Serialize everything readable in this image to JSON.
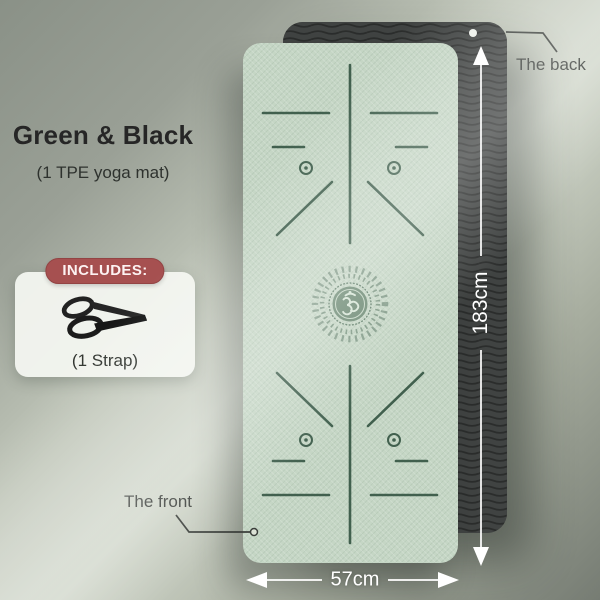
{
  "header": {
    "title": "Green & Black",
    "subtitle": "(1 TPE yoga mat)"
  },
  "includes": {
    "badge_label": "INCLUDES:",
    "item_label": "(1 Strap)"
  },
  "callouts": {
    "back_label": "The back",
    "front_label": "The front"
  },
  "dimensions": {
    "length": "183cm",
    "width": "57cm"
  },
  "icons": {
    "strap-icon": "black carry strap with two loops",
    "om-icon": "ॐ",
    "mat-hole-dot": "white hanging hole on back mat"
  },
  "colors": {
    "background_dark": "#8a9187",
    "background_light_beam": "#d2d8cc",
    "background_bottom_right": "#767c73",
    "mat_front_green": "#c5d6c5",
    "mat_back_black": "#404342",
    "mat_line_art": "#41604e",
    "mandala_center": "#6d8a74",
    "includes_badge_red": "#a65050",
    "includes_card_white": "#f3f5f0",
    "dimension_text_white": "#ffffff",
    "label_text_dark": "#383c38"
  }
}
